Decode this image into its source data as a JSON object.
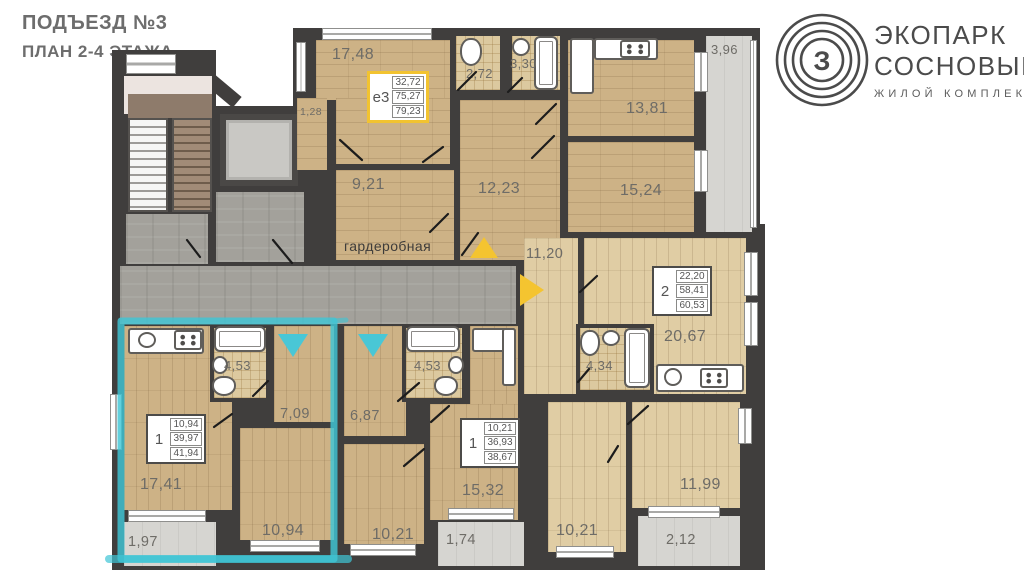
{
  "header": {
    "entrance": "ПОДЪЕЗД №3",
    "floor_plan": "ПЛАН 2-4 ЭТАЖА"
  },
  "brand": {
    "name_line1": "ЭКОПАРК",
    "name_line2": "СОСНОВЫЙ",
    "tagline": "ЖИЛОЙ КОМПЛЕКС",
    "monogram": "З"
  },
  "colors": {
    "highlight": "#3fc6d6",
    "entry_marker_yellow": "#f4c430",
    "wall": "#403e3d",
    "wood_floor": "#cdb286",
    "wood_floor_light": "#e0cda4",
    "tile_floor": "#dcc99f",
    "common_area": "#a3a19b",
    "balcony": "#d6d5d1"
  },
  "apartments": {
    "e3": {
      "type": "е3",
      "living_area": "32,72",
      "area": "75,27",
      "total_area": "79,23"
    },
    "two_room": {
      "type": "2",
      "living_area": "22,20",
      "area": "58,41",
      "total_area": "60,53"
    },
    "one_room_left": {
      "type": "1",
      "living_area": "10,94",
      "area": "39,97",
      "total_area": "41,94"
    },
    "one_room_mid": {
      "type": "1",
      "living_area": "10,21",
      "area": "36,93",
      "total_area": "38,67"
    }
  },
  "rooms": {
    "r1748": "17,48",
    "r128": "1,28",
    "r921": "9,21",
    "wardrobe": "гардеробная",
    "wc272": "2,72",
    "bath330": "3,30",
    "r1223": "12,23",
    "r1381": "13,81",
    "r1524": "15,24",
    "balc396": "3,96",
    "hall1120": "11,20",
    "bath434": "4,34",
    "r2067": "20,67",
    "r1021_right": "10,21",
    "r1199": "11,99",
    "balc212": "2,12",
    "bath453_left": "4,53",
    "hall709": "7,09",
    "r1741": "17,41",
    "r1094": "10,94",
    "balc197": "1,97",
    "hall687": "6,87",
    "bath453_mid": "4,53",
    "r1532": "15,32",
    "r1021_mid": "10,21",
    "balc174": "1,74"
  }
}
